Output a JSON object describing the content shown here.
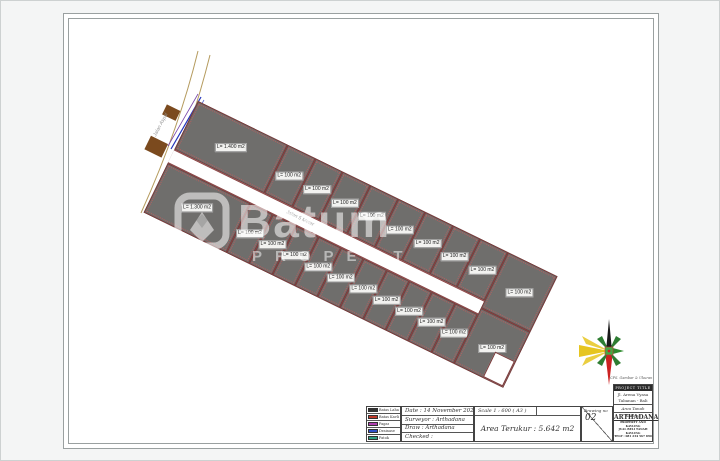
{
  "plan": {
    "left_road_label": "Jalan Aspal",
    "center_road_label": "Jalan 5 Meter",
    "top_plots": [
      "L= 1.400 m2",
      "L= 100 m2",
      "L= 100 m2",
      "L= 100 m2",
      "L= 100 m2",
      "L= 100 m2",
      "L= 100 m2",
      "L= 100 m2",
      "L= 100 m2"
    ],
    "right_top_plot": "L= 100 m2",
    "bottom_plots": [
      "L= 1.300 m2",
      "L= 100 m2",
      "L= 100 m2",
      "L= 100 m2",
      "L= 100 m2",
      "L= 100 m2",
      "L= 100 m2",
      "L= 100 m2",
      "L= 100 m2",
      "L= 100 m2",
      "L= 100 m2"
    ],
    "right_bottom_plot": "L= 100 m2"
  },
  "watermark": {
    "brand": "Batum",
    "subtitle": "PROPERT"
  },
  "title_block": {
    "legend": [
      {
        "label": "Batas Lahan",
        "color": "#333333"
      },
      {
        "label": "Batas Kavling",
        "color": "#c0392b"
      },
      {
        "label": "Pagar",
        "color": "#b040b0"
      },
      {
        "label": "Drainase",
        "color": "#3050c8"
      },
      {
        "label": "Patok",
        "color": "#30a080"
      }
    ],
    "info_rows": {
      "date": "Date : 14 November 2023",
      "surveyor": "Surveyor :  Arthadana",
      "draw": "Draw :  Arthadana",
      "checked": "Checked :"
    },
    "scale": "Scale 1 : 600 ( A3 )",
    "area": "Area Terukur : 5.642 m2",
    "drawing_no_label": "Drawing no",
    "drawing_no": "02",
    "company": {
      "note": "CPS. Gambar & Ukuran",
      "header": "PROJECT TITLE",
      "address1": "Jl. Arena Vyasa",
      "address2": "Tabanan - Bali",
      "area_label": "Area Tanah Kavling",
      "name": "ARTHADANA",
      "line1": "PROPERTY AND KAVLING",
      "line2": "JUAL BELI TANAH KAVLING",
      "line3": "TELP : 081 234 567 890"
    }
  }
}
